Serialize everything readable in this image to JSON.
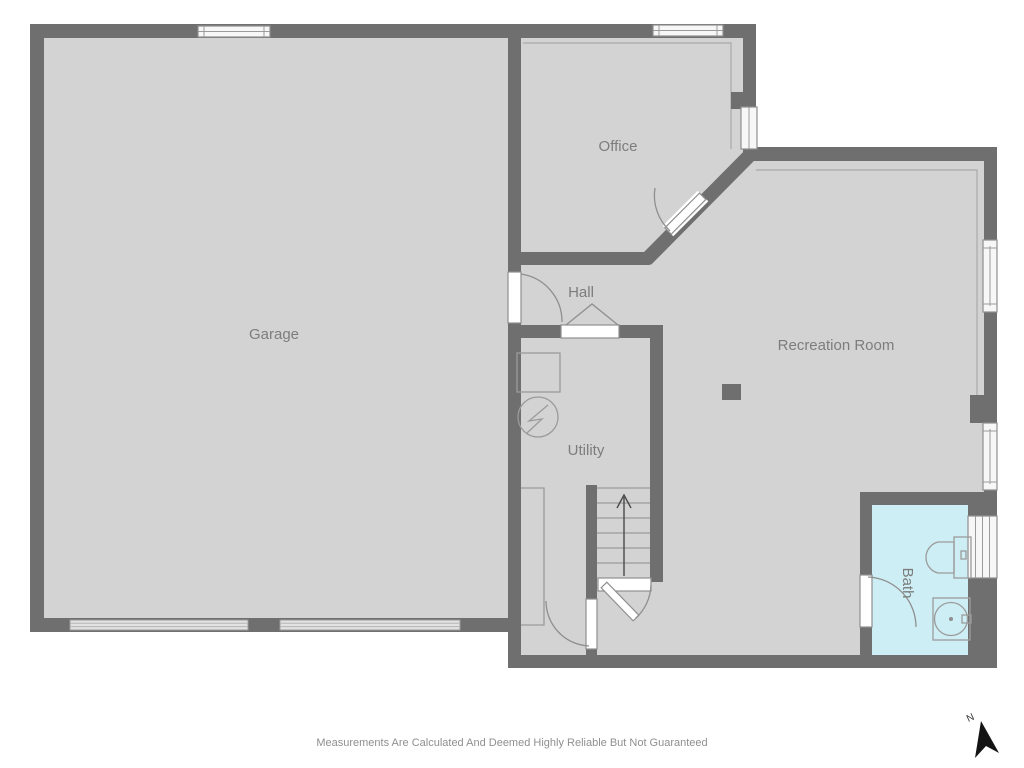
{
  "floor_plan": {
    "rooms": [
      {
        "id": "garage",
        "label": "Garage"
      },
      {
        "id": "office",
        "label": "Office"
      },
      {
        "id": "hall",
        "label": "Hall"
      },
      {
        "id": "utility",
        "label": "Utility"
      },
      {
        "id": "recreation_room",
        "label": "Recreation Room"
      },
      {
        "id": "bath",
        "label": "Bath"
      }
    ],
    "compass": {
      "label": "N"
    },
    "disclaimer": "Measurements Are Calculated And Deemed Highly Reliable But Not Guaranteed",
    "colors": {
      "background": "#ffffff",
      "wall": "#6f6f6f",
      "floor": "#d3d3d3",
      "bath_floor": "#cdeef4",
      "label_text": "#7d7d7d",
      "fixture_line": "#8f8f8f"
    }
  }
}
